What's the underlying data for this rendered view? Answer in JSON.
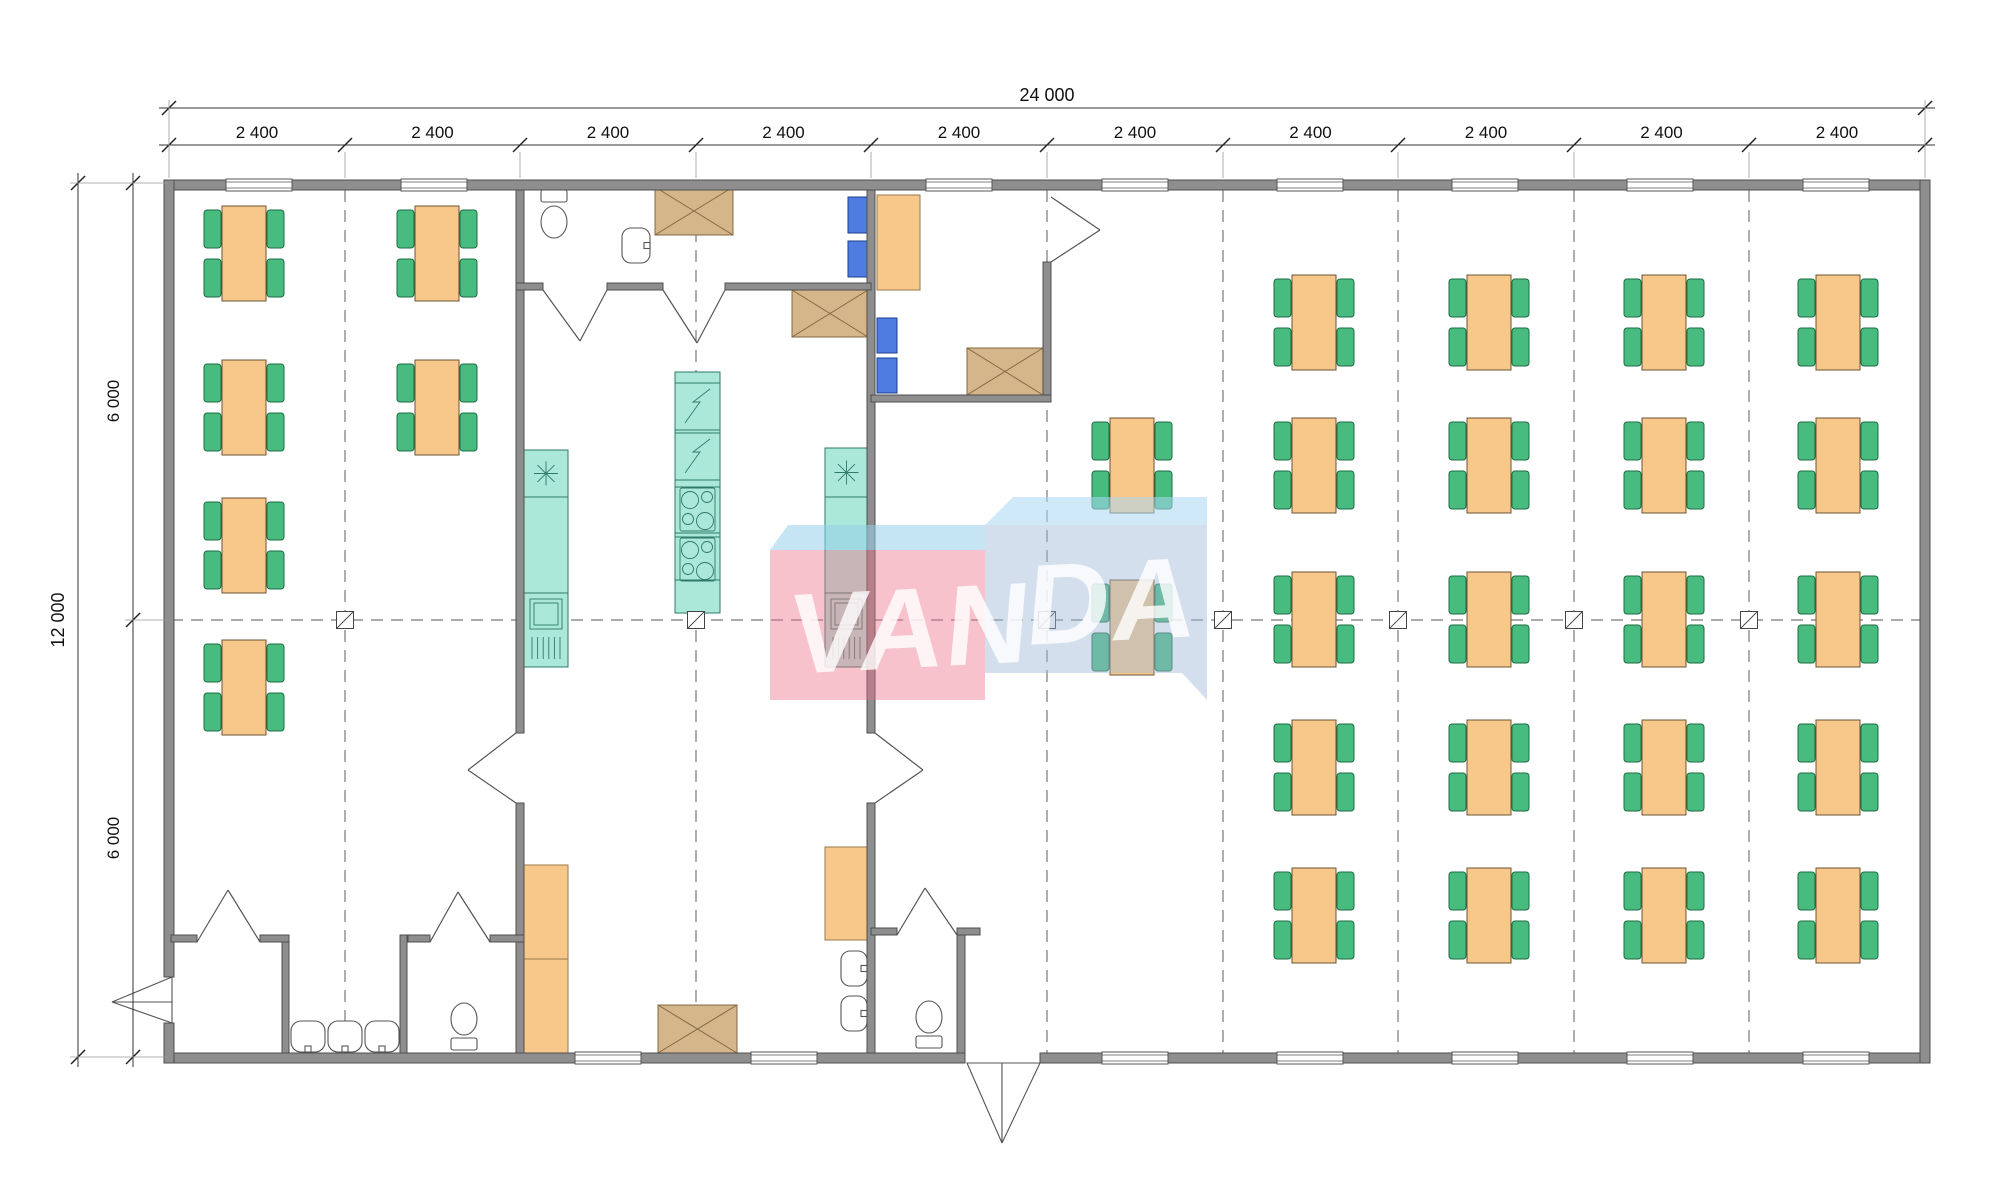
{
  "page": {
    "title": "Modular building floor plan 24000 x 12000"
  },
  "watermark": {
    "text_left": "VAN",
    "text_right": "DA",
    "faces": [
      {
        "name": "pink-top-face",
        "points": "770,550 788,525 985,525 985,550",
        "fill": "rgba(150,205,235,0.55)"
      },
      {
        "name": "pink-front-face",
        "points": "770,550 985,550 985,700 770,700",
        "fill": "rgba(238,110,135,0.42)"
      },
      {
        "name": "blue-top-face",
        "points": "985,525 1013,497 1207,497 1207,525",
        "fill": "rgba(170,215,242,0.55)"
      },
      {
        "name": "blue-front-face",
        "points": "985,525 1207,525 1207,700 1182,673 985,673",
        "fill": "rgba(160,185,215,0.45)"
      }
    ]
  },
  "dimensions": {
    "axes_x": [
      169,
      345,
      520,
      696,
      871,
      1047,
      1223,
      1398,
      1574,
      1749,
      1925
    ],
    "top_total": {
      "label": "24 000",
      "y": 108,
      "x1": 169,
      "x2": 1925,
      "label_x": 1047
    },
    "top_segments": {
      "y": 145,
      "labels": [
        "2 400",
        "2 400",
        "2 400",
        "2 400",
        "2 400",
        "2 400",
        "2 400",
        "2 400",
        "2 400",
        "2 400"
      ]
    },
    "left_total": {
      "label": "12 000",
      "x": 78,
      "y1": 183,
      "y2": 1057
    },
    "left_halves": {
      "x": 133,
      "ticks": [
        183,
        620,
        1057
      ],
      "labels": [
        {
          "text": "6 000",
          "y": 401
        },
        {
          "text": "6 000",
          "y": 838
        }
      ]
    }
  },
  "plan": {
    "center_y": 620,
    "dash_v": [
      345,
      696,
      1047,
      1223,
      1398,
      1574,
      1749
    ],
    "markers": [
      345,
      696,
      1047,
      1223,
      1398,
      1574,
      1749
    ],
    "walls": [
      [
        164,
        180,
        1766,
        10
      ],
      [
        164,
        1053,
        801,
        10
      ],
      [
        1040,
        1053,
        890,
        10
      ],
      [
        164,
        180,
        10,
        797
      ],
      [
        164,
        1023,
        10,
        40
      ],
      [
        1920,
        180,
        10,
        883
      ],
      [
        516,
        190,
        8,
        543
      ],
      [
        516,
        803,
        8,
        250
      ],
      [
        867,
        190,
        8,
        543
      ],
      [
        867,
        803,
        8,
        250
      ],
      [
        1043,
        262,
        8,
        140
      ],
      [
        282,
        935,
        7,
        118
      ],
      [
        400,
        935,
        7,
        118
      ],
      [
        957,
        935,
        8,
        118
      ],
      [
        516,
        283,
        27,
        7
      ],
      [
        607,
        283,
        56,
        7
      ],
      [
        725,
        283,
        146,
        7
      ],
      [
        871,
        395,
        180,
        7
      ],
      [
        171,
        935,
        26,
        7
      ],
      [
        260,
        935,
        29,
        7
      ],
      [
        408,
        935,
        22,
        7
      ],
      [
        490,
        935,
        34,
        7
      ],
      [
        871,
        928,
        26,
        7
      ],
      [
        957,
        928,
        23,
        7
      ]
    ],
    "windows": {
      "w": 66,
      "h": 12,
      "top": {
        "y": 179,
        "xs": [
          226,
          401,
          926,
          1102,
          1277,
          1452,
          1627,
          1803
        ]
      },
      "bottom": {
        "y": 1052,
        "xs": [
          575,
          751,
          1102,
          1277,
          1452,
          1627,
          1803
        ]
      }
    },
    "tables": {
      "w": 44,
      "h": 95,
      "chair_w": 17,
      "chair_h": 38,
      "chair_dy1": 4,
      "chair_dy2": 53,
      "singles": [
        [
          222,
          206
        ],
        [
          222,
          360
        ],
        [
          222,
          498
        ],
        [
          222,
          640
        ],
        [
          415,
          206
        ],
        [
          415,
          360
        ],
        [
          1110,
          418
        ],
        [
          1110,
          580
        ]
      ],
      "hall_cols": [
        1292,
        1467,
        1642,
        1816
      ],
      "hall_rows": [
        275,
        418,
        572,
        720,
        868
      ]
    },
    "counters": [
      {
        "x": 524,
        "y": 450,
        "w": 44,
        "h": 217,
        "fridge_h": 47,
        "sink_top": 143
      },
      {
        "x": 825,
        "y": 448,
        "w": 43,
        "h": 219,
        "fridge_h": 49,
        "sink_top": 145
      }
    ],
    "island": {
      "x": 675,
      "y": 372,
      "w": 45,
      "h": 241,
      "breaks": [
        11,
        58,
        61,
        108,
        115,
        161,
        165,
        208
      ],
      "zig_tops": [
        11,
        61
      ],
      "burner_tops": [
        115,
        165
      ]
    },
    "cabinets_x": [
      [
        655,
        187,
        78,
        48
      ],
      [
        792,
        290,
        76,
        47
      ],
      [
        967,
        348,
        76,
        47
      ],
      [
        658,
        1005,
        79,
        48
      ]
    ],
    "orange_units": [
      [
        877,
        195,
        43,
        95
      ],
      [
        524,
        865,
        44,
        94
      ],
      [
        524,
        959,
        44,
        94
      ],
      [
        825,
        847,
        43,
        93
      ]
    ],
    "blue_units": [
      [
        848,
        197,
        22,
        36
      ],
      [
        848,
        241,
        22,
        36
      ],
      [
        877,
        318,
        20,
        35
      ],
      [
        877,
        358,
        20,
        35
      ]
    ],
    "toilets": [
      {
        "tank": [
          541,
          190,
          26,
          12
        ],
        "bowl": [
          554,
          222,
          13,
          16
        ]
      },
      {
        "tank": [
          451,
          1038,
          26,
          12
        ],
        "bowl": [
          464,
          1019,
          13,
          16
        ]
      },
      {
        "tank": [
          916,
          1036,
          26,
          12
        ],
        "bowl": [
          929,
          1017,
          13,
          16
        ]
      }
    ],
    "basins": [
      {
        "r": [
          622,
          228,
          28,
          35
        ],
        "side": "right"
      },
      {
        "r": [
          841,
          951,
          26,
          35
        ],
        "side": "right"
      },
      {
        "r": [
          841,
          996,
          26,
          35
        ],
        "side": "right"
      },
      {
        "r": [
          291,
          1021,
          34,
          31
        ],
        "side": "bottom"
      },
      {
        "r": [
          328,
          1021,
          34,
          31
        ],
        "side": "bottom"
      },
      {
        "r": [
          365,
          1021,
          34,
          31
        ],
        "side": "bottom"
      }
    ],
    "doors": [
      [
        543,
        290,
        607,
        290,
        580,
        341
      ],
      [
        663,
        290,
        725,
        290,
        697,
        343
      ],
      [
        1051,
        197,
        1051,
        262,
        1100,
        230
      ],
      [
        516,
        733,
        516,
        803,
        468,
        770
      ],
      [
        875,
        733,
        875,
        803,
        923,
        770
      ],
      [
        197,
        942,
        260,
        942,
        228,
        890
      ],
      [
        430,
        942,
        490,
        942,
        458,
        892
      ],
      [
        897,
        935,
        957,
        935,
        925,
        888
      ]
    ],
    "entrances": [
      {
        "p1": "172,977 112,1002 172,1002",
        "p2": "172,1023 112,1002 172,1002"
      },
      {
        "p1": "967,1063 1002,1143 1002,1063",
        "p2": "1040,1063 1002,1143 1002,1063"
      }
    ]
  }
}
